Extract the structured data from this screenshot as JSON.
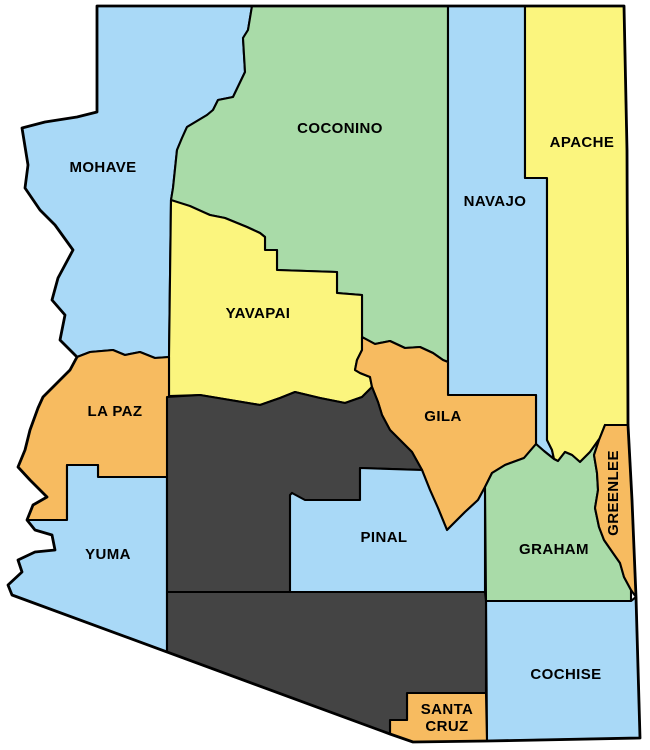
{
  "map": {
    "background": "#ffffff",
    "outline_color": "#000000",
    "label_color": "#000000",
    "palette": {
      "blue": "#A9D9F7",
      "green": "#A9DBA8",
      "yellow": "#FBF57E",
      "orange": "#F7BB60",
      "dark_gray": "#444444"
    },
    "counties": [
      {
        "id": "mohave",
        "label": "MOHAVE",
        "fill": "#A9D9F7",
        "label_x": 103,
        "label_y": 167,
        "path": "M97,6 L252,6 L248,30 L243,38 L245,72 L233,97 L218,100 L213,110 L207,115 L187,127 L182,138 L177,150 L173,188 L171,200 L169,357 L155,358 L140,352 L125,355 L113,350 L90,352 L77,357 L60,340 L65,315 L52,300 L58,278 L73,250 L55,225 L40,210 L25,188 L28,165 L22,128 L45,122 L77,117 L97,112 Z"
      },
      {
        "id": "coconino",
        "label": "COCONINO",
        "fill": "#A9DBA8",
        "label_x": 340,
        "label_y": 128,
        "path": "M252,6 L448,6 L448,362 L443,360 L433,353 L420,347 L405,348 L390,341 L375,344 L362,337 L362,295 L337,293 L337,272 L277,270 L277,250 L265,250 L265,237 L260,233 L247,227 L225,218 L210,215 L171,200 L173,188 L177,150 L182,138 L187,127 L207,115 L213,110 L218,100 L233,97 L245,72 L243,38 L248,30 Z"
      },
      {
        "id": "navajo",
        "label": "NAVAJO",
        "fill": "#A9D9F7",
        "label_x": 495,
        "label_y": 201,
        "path": "M448,6 L525,6 L525,178 L547,178 L547,440 L552,450 L554,459 L544,451 L536,444 L536,395 L448,395 Z"
      },
      {
        "id": "apache",
        "label": "APACHE",
        "fill": "#FBF57E",
        "label_x": 582,
        "label_y": 142,
        "path": "M525,6 L624,6 L627,150 L628,300 L628,425 L605,425 L600,438 L590,452 L580,462 L572,455 L565,452 L558,461 L554,459 L552,450 L547,440 L547,178 L525,178 Z"
      },
      {
        "id": "yavapai",
        "label": "YAVAPAI",
        "fill": "#FBF57E",
        "label_x": 258,
        "label_y": 313,
        "path": "M171,200 L190,206 L210,215 L225,218 L247,227 L260,233 L265,237 L265,250 L277,250 L277,270 L337,272 L337,293 L362,295 L362,337 L362,350 L357,360 L355,370 L360,373 L370,377 L372,387 L367,392 L362,397 L345,403 L320,398 L295,392 L280,398 L260,405 L230,400 L200,395 L169,396 L169,357 Z"
      },
      {
        "id": "la_paz",
        "label": "LA PAZ",
        "fill": "#F7BB60",
        "label_x": 115,
        "label_y": 411,
        "path": "M77,357 L90,352 L113,350 L125,355 L140,352 L155,358 L169,357 L169,396 L167,477 L98,477 L98,465 L67,465 L67,520 L27,520 L33,505 L47,497 L30,480 L18,467 L25,450 L30,430 L38,408 L43,397 L50,390 L58,382 L70,370 Z"
      },
      {
        "id": "yuma",
        "label": "YUMA",
        "fill": "#A9D9F7",
        "label_x": 108,
        "label_y": 554,
        "path": "M67,465 L98,465 L98,477 L167,477 L167,652 L12,595 L8,585 L22,572 L18,560 L35,552 L55,550 L52,535 L35,530 L27,520 L67,520 Z"
      },
      {
        "id": "gila",
        "label": "GILA",
        "fill": "#F7BB60",
        "label_x": 443,
        "label_y": 416,
        "path": "M362,337 L375,344 L390,341 L405,348 L420,347 L433,353 L443,360 L448,362 L448,395 L536,395 L536,444 L524,458 L505,465 L492,473 L485,487 L478,500 L465,512 L447,530 L438,508 L430,490 L422,470 L412,452 L400,440 L390,430 L382,415 L378,402 L372,387 L370,377 L360,373 L355,370 L357,360 L362,350 Z"
      },
      {
        "id": "maricopa",
        "label": "",
        "fill": "#444444",
        "label_x": 230,
        "label_y": 500,
        "path": "M167,397 L200,395 L230,400 L260,405 L280,398 L295,392 L320,398 L345,403 L362,397 L367,392 L372,387 L378,402 L382,415 L390,430 L400,440 L412,452 L422,470 L360,468 L360,500 L300,500 L292,493 L290,592 L167,592 Z"
      },
      {
        "id": "pinal",
        "label": "PINAL",
        "fill": "#A9D9F7",
        "label_x": 384,
        "label_y": 537,
        "path": "M292,493 L305,500 L360,500 L360,468 L422,470 L430,490 L438,508 L447,530 L465,512 L478,500 L485,487 L485,592 L290,592 L290,495 Z"
      },
      {
        "id": "graham",
        "label": "GRAHAM",
        "fill": "#A9DBA8",
        "label_x": 554,
        "label_y": 549,
        "path": "M536,444 L544,451 L554,459 L558,461 L565,452 L572,455 L580,462 L590,452 L600,438 L605,425 L599,440 L594,455 L597,473 L598,490 L595,508 L599,527 L604,540 L613,553 L620,563 L624,577 L631,590 L631,601 L486,601 L485,487 L492,473 L505,465 L524,458 Z"
      },
      {
        "id": "greenlee",
        "label": "GREENLEE",
        "fill": "#F7BB60",
        "label_x": 613,
        "label_y": 493,
        "label_rotation": -90,
        "path": "M605,425 L628,425 L632,500 L636,597 L631,590 L624,577 L620,563 L613,553 L604,540 L599,527 L595,508 L598,490 L597,473 L594,455 L599,440 Z"
      },
      {
        "id": "cochise",
        "label": "COCHISE",
        "fill": "#A9D9F7",
        "label_x": 566,
        "label_y": 674,
        "path": "M486,601 L631,601 L636,597 L640,738 L487,741 Z"
      },
      {
        "id": "santa_cruz",
        "label": "SANTA CRUZ",
        "fill": "#F7BB60",
        "label_x": 447,
        "label_y": 717,
        "label_lines": [
          "SANTA",
          "CRUZ"
        ],
        "path": "M407,693 L486,693 L487,741 L413,742 L390,734 L390,720 L407,720 Z"
      },
      {
        "id": "pima",
        "label": "",
        "fill": "#444444",
        "label_x": 300,
        "label_y": 640,
        "path": "M167,592 L485,592 L486,601 L486,693 L407,693 L407,720 L390,720 L390,734 L167,652 Z"
      }
    ],
    "state_outline_path": "M97,6 L624,6 L627,150 L628,425 L632,500 L636,597 L640,738 L487,741 L413,742 L390,734 L12,595 L8,585 L22,572 L18,560 L35,552 L55,550 L52,535 L35,530 L27,520 L33,505 L47,497 L30,480 L18,467 L25,450 L30,430 L38,408 L43,397 L50,390 L58,382 L70,370 L77,357 L60,340 L65,315 L52,300 L58,278 L73,250 L55,225 L40,210 L25,188 L28,165 L22,128 L45,122 L77,117 L97,112 Z"
  }
}
